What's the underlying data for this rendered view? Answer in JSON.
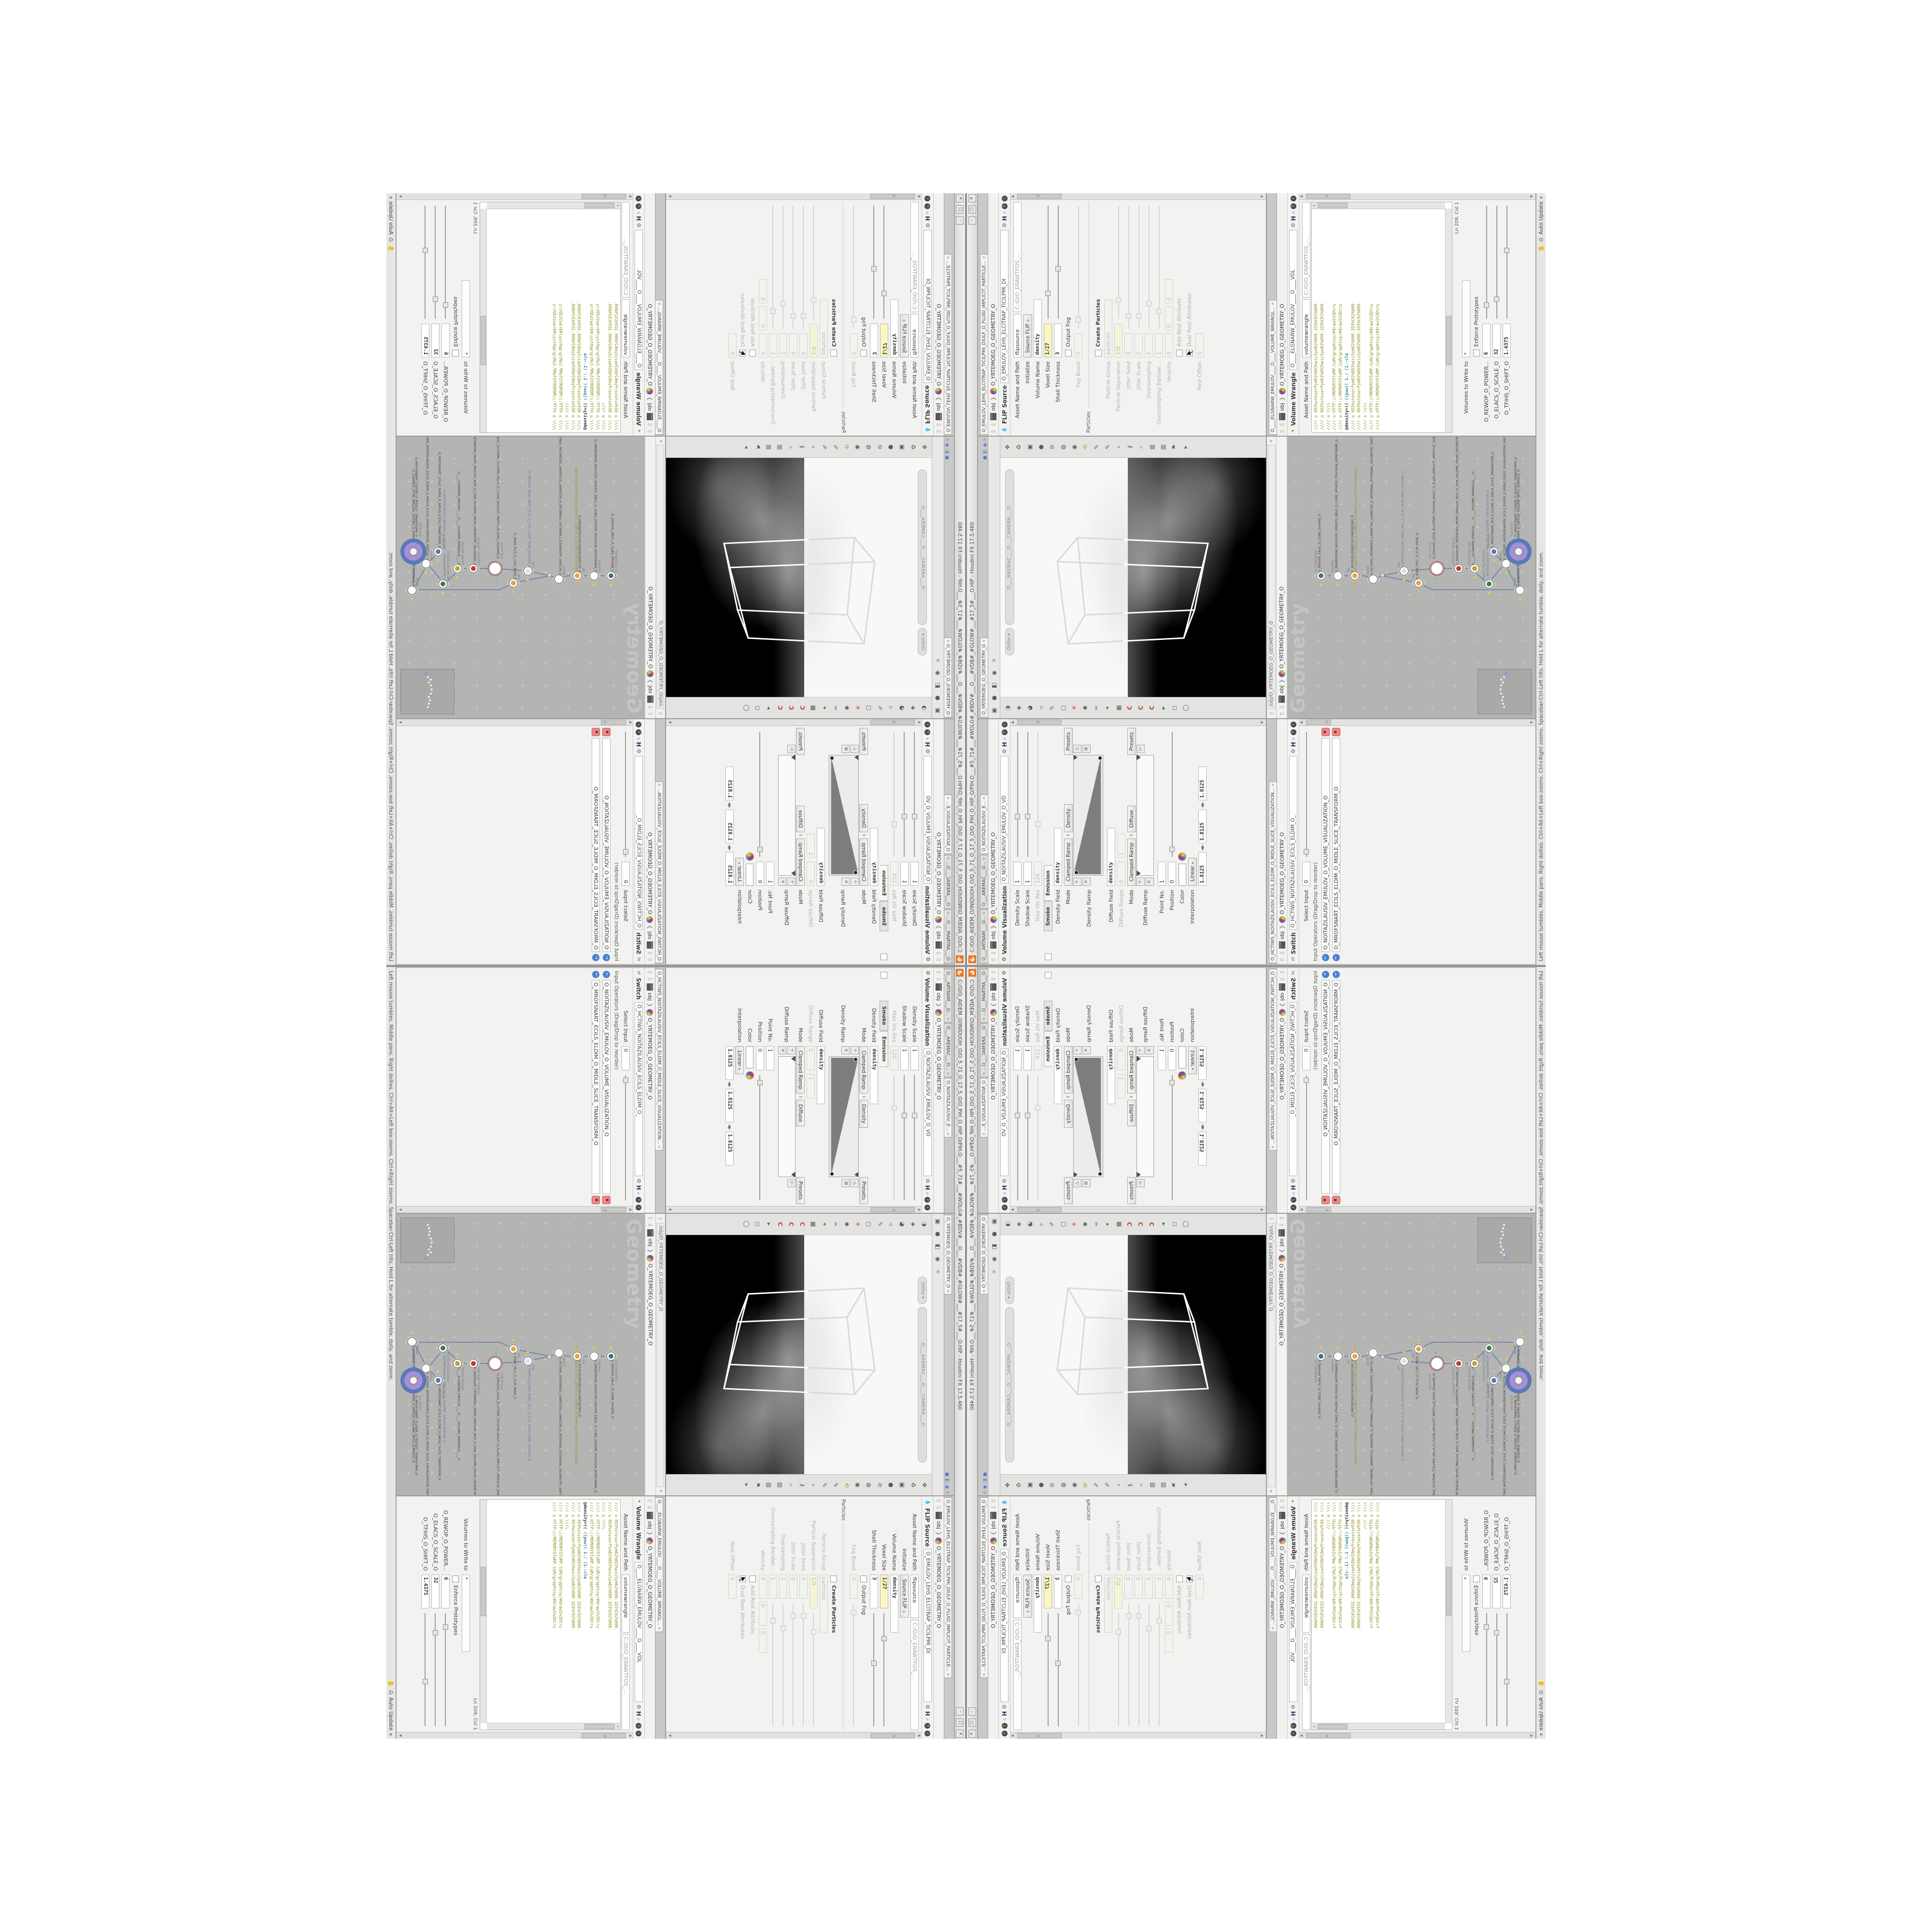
{
  "window": {
    "title": "C:/O/O_AIDEM_O/INIDUOH_O/O_5_71_O_17_5_O/O_PIH_O_HIP_O/PIH.O___#5_71#___#WOLG#_#BDV#___O___#VDB#_#GLOW#___#17_5#___O.HIP - Houdini FX 17.5.460",
    "buttons": {
      "min": "–",
      "max": "□",
      "close": "✕"
    }
  },
  "statusbar": {
    "help": "Left mouse tumbles. Middle pans. Right dollies. Ctrl+Alt+Left box-zooms. Ctrl+Right zooms. Spacebar-Ctrl-Left tilts. Hold L for alternate tumble, dolly, and zoom.",
    "auto_update": "Auto Update"
  },
  "breadcrumb": {
    "root": "obj",
    "net": "O_YRTEMOEG_O_GEOMETRY_O",
    "sep": "❯"
  },
  "panes": {
    "viz": {
      "tabs": [
        "O___ARTNAM___O...",
        "O___AREMAC___O...",
        "O_NOITAZILAUSIV_E..."
      ],
      "type": "Volume Visualization",
      "name": "O_NOITAZILAUSIV_EMULOV_O_VO",
      "rows": {
        "dscale": {
          "l": "Density Scale",
          "v": "1"
        },
        "sscale": {
          "l": "Shadow Scale",
          "v": "1"
        },
        "maxvis": {
          "l": "Max Vis Res",
          "v": "128"
        },
        "dfield": {
          "l": "Density Field",
          "v": "density"
        },
        "mode1": {
          "l": "Mode",
          "v": "Clamped Ramp",
          "v2": "Density",
          "btn": "Presets"
        },
        "dramp": {
          "l": "Density Ramp"
        },
        "difffield": {
          "l": "Diffuse Field",
          "v": "density"
        },
        "diffrange": {
          "l": "Diffuse Range",
          "v": "0",
          "v2": "1"
        },
        "mode2": {
          "l": "Mode",
          "v": "Clamped Ramp",
          "v2": "Diffuse",
          "btn": "Presets"
        },
        "difframp": {
          "l": "Diffuse Ramp"
        },
        "pointno": {
          "l": "Point No.",
          "v": "1"
        },
        "pos": {
          "l": "Position",
          "v": "0"
        },
        "color": {
          "l": "Color"
        },
        "interp": {
          "l": "Interpolation",
          "v": "Linear"
        }
      },
      "subtabs": [
        "Smoke",
        "Emission"
      ],
      "bottom_values": [
        "1.8125",
        "1.8125",
        "1.8125"
      ]
    },
    "viewport": {
      "tab": "O_YRTEMOEG_O_GEOMETRY_O",
      "ortho": "Ortho ▾",
      "camera": "O___AREMAC___O___CAMERA___O",
      "top_icons": [
        "▣",
        "●",
        "◧",
        "◉",
        "⍟"
      ],
      "right_icons": [
        "✥",
        "♻",
        "▣",
        "●",
        "⊘",
        "◍",
        "◉",
        "⟲",
        "✎",
        "✎",
        "∘",
        "⚷",
        "⌕",
        "▥",
        "▥",
        "⚑",
        "▸"
      ],
      "left_icons": [
        "◑",
        "◈",
        "◕",
        "◃",
        "✎",
        "▢",
        "✳",
        "✺",
        "✂",
        "✦",
        "▦",
        "C",
        "C",
        "C",
        "▸",
        "◻",
        "◯"
      ]
    },
    "flip": {
      "tab": "O_EMULOV_LEHS_ELCITRAP_TICILPMI_DIULF_O_FLUID_IMPLICIT_PARTICLE...",
      "type": "FLIP Source",
      "name": "O_EMULOV_LEHS_ELCITRAP_TICILPMI_DI",
      "asset_label": "Asset Name and Path",
      "asset_name": "flipsource",
      "asset_path": "C:/O/O_ERAWTFOS_...",
      "section": "Particles",
      "rows": {
        "init": {
          "l": "Initialize",
          "v": "Source FLIP"
        },
        "vname": {
          "l": "Volume Name",
          "v": "density"
        },
        "voxel": {
          "l": "Voxel Size",
          "v": "1/27"
        },
        "shell": {
          "l": "Shell Thickness",
          "v": "3"
        },
        "outputfog": {
          "l": "Output Fog"
        },
        "fogboost": {
          "l": "Fog Boost",
          "v": "0"
        },
        "createp": {
          "l": "Create Particles"
        },
        "pgroup": {
          "l": "Particle Group",
          "v": "particles"
        },
        "psep": {
          "l": "Particle Separation",
          "v": "1/9"
        },
        "jseed": {
          "l": "Jitter Seed",
          "v": "0"
        },
        "jscale": {
          "l": "Jitter Scale",
          "v": "0"
        },
        "oversamp": {
          "l": "Oversampling",
          "v": "2"
        },
        "obw": {
          "l": "Oversampling Bandwi...",
          "v": "1"
        },
        "vel": {
          "l": "Velocity",
          "v": "0",
          "v2": "0",
          "v3": "0"
        },
        "addrest": {
          "l": "Add Rest Attribute"
        },
        "dualrest": {
          "l": "Dual Rest Attributes"
        },
        "restoff": {
          "l": "Rest Offset",
          "v": "0"
        }
      }
    },
    "switch": {
      "tab": "O_HCTIWS_NOITAZILAUSIV_ECILS_ELDIM_O_MIDLE_SLICE_VISUALIZATION...",
      "type": "Switch",
      "name": "O_HCTIWS_NOITAZILAUSIV_ECILS_ELDIM_O_",
      "rows": {
        "select": {
          "l": "Select Input",
          "v": "0"
        }
      },
      "list_header": "Input Operators (Drag/Drop to reorder)",
      "inputs": [
        "O_NOITAZILAUSIV_EMULOV_O_VOLUME_VISUALIZATION_O",
        "O_MROFSNART_ECILS_ELDIM_O_MIDLE_SLICE_TRANSFORM_O"
      ]
    },
    "network": {
      "path": "/obj/O_YRTEMOEG_O_GEOMETRY_O",
      "watermark": "Geometry",
      "nodes": [
        {
          "t": "an_CubeSphere",
          "n": "O_EREHPS_EBUC_O_CUBE_SPHERE_O"
        },
        {
          "t": "PolyWire",
          "n": "O_EMARFERIW_NOGYLOP_EREHPS_EBUC_O_CUBE_SPHERE_POLYGON_WIREFRAME_O"
        },
        {
          "t": "File",
          "n": "O_N©DUSLRU(BO;GO;GAPUJO(BO_D",
          "sub": "JBO.MD3.PETS.TRPOLS_O_5SURF/G_O_GEM/G3_O.SLOPFT.STEP.3DVA.OBJ"
        },
        {
          "t": "Switch",
          "n": "O_HCTIWS_YRTEMOEG_LANRETXE_LANRETNI_O_INTERNAL_EXTERNAL_GEOMETRY_SWITCH_O"
        },
        {
          "t": "Clip",
          "n": "O_EMULOV_EDAF_RUSC_PILC_O_CLIP_CSUR_FADE_VOLUME_O"
        },
        {
          "t": "Clip",
          "n": "O_EDAF_PILC_O_CLIP_FADE_O"
        },
        {
          "t": "FLIP Source",
          "n": "O_EMULOV_LEHS_ELCITRAP_TICILPMI_DIULF_O_FLUID_IMPLICIT_PARTICLE_SHEL_VOLUME_O"
        },
        {
          "t": "VDB from Polygons",
          "n": "O_SNOGILOP_YRTEMOEG_MORF_EMULOV_BDV_O_VDB_VOLUME_FROM_GEOMETRY_POLYGONS_O"
        },
        {
          "t": "Volume Wrangle",
          "n": "O____ELGNARW_EMULOV____O____VOLUME_WRANGLE____O"
        },
        {
          "t": "Volume Visualization",
          "n": "O_NOITAZILAUSIV_EMULOV_O_VOLUME_VISUALIZATION_O"
        },
        {
          "t": "Transform",
          "n": "O_MROFSNART_ECILS_ELDIM_O_MIDLE_SLICE_TRANSFORM_O"
        },
        {
          "t": "Switch",
          "n": "O_HCTIWS_NOITAZILAUSIV_ECILS_ELDIM_O_MIDLE_SLICE_VISUALIZATION_SWITCH_O"
        },
        {
          "t": "Merge",
          "n": "O_ECAFRUS_HTIW_EMULOV_EGREM_O_MERGE_VOLUME_WITH_SURFACE_O"
        },
        {
          "t": "Transform",
          "n": "O_MROFSNART_TLUSER_O_RESULT_TRANSFORM_O"
        }
      ]
    },
    "wrangle": {
      "tab": "O____ELGNARW_EMULOV____O____VOLUME_WRANGL...",
      "type": "Volume Wrangle",
      "name": "O____ELGNARW_EMULOV____O____VOL",
      "asset_label": "Asset Name and Path",
      "asset_name": "volumewrangle",
      "asset_path": "C:/O/O_ERAWTFOS_...",
      "code": [
        "//// ◎ 0D3%steserPym62%0D3%eziSym62%000.1D3%C62%000.",
        "//// ◎ 0D3%steserPym62%0D3%eziSym62%000.1D3%C62%000.",
        "//// ◎ \\\\\\\\",
        "//// ◎ HTTP://MEMORYST◎MP.C◎M/graphtoy/#draw1%3Dtru",
        "//// ◎ HTTP://MEMORYST◎MP.C◎M/graphtoy/#draw1%3Dtru",
        ""
      ],
      "stmt": {
        "a": "@density=((",
        "b": "      ((pow((",
        "c": "      1./ (1.-cla"
      },
      "code2": [
        "//// ◎ 0D3%steserPym62%0D3%eziSym62%000.1D3%C62%000.",
        "//// ◎ 0D3%steserPym62%0D3%eziSym62%000.1D3%C62%000.",
        "//// ◎ \\\\\\\\",
        "//// ◎ HTTP://MEMORYST◎MP.C◎M/graphtoy/#draw1%3Dtru",
        "//// ◎ HTTP://MEMORYST◎MP.C◎M/graphtoy/#draw1%3Dtru"
      ],
      "cursor_pos": "Ln 209, Col 1",
      "volumes_label": "Volumes to Write to",
      "volumes_value": "*",
      "enforce": "Enforce Prototypes",
      "spares": [
        {
          "l": "O_REWOP_O_POWER...",
          "v": "6"
        },
        {
          "l": "O_ELACS_O_SCALE_O",
          "v": "32"
        },
        {
          "l": "O_TFIHS_O_SHIFT_O",
          "v": "1.4375"
        }
      ]
    }
  },
  "colors": {
    "houdini_orange": "#e87722",
    "key_yellow": "#fbf7c0",
    "code_olive": "#8f8f1f",
    "code_teal": "#2e8b8b",
    "wire": "#5f7dab",
    "halo_purple": "#a58fd8",
    "halo_blue": "#5a79b5",
    "canvas_grey": "#b4b4b2",
    "viewport_black": "#000000"
  }
}
